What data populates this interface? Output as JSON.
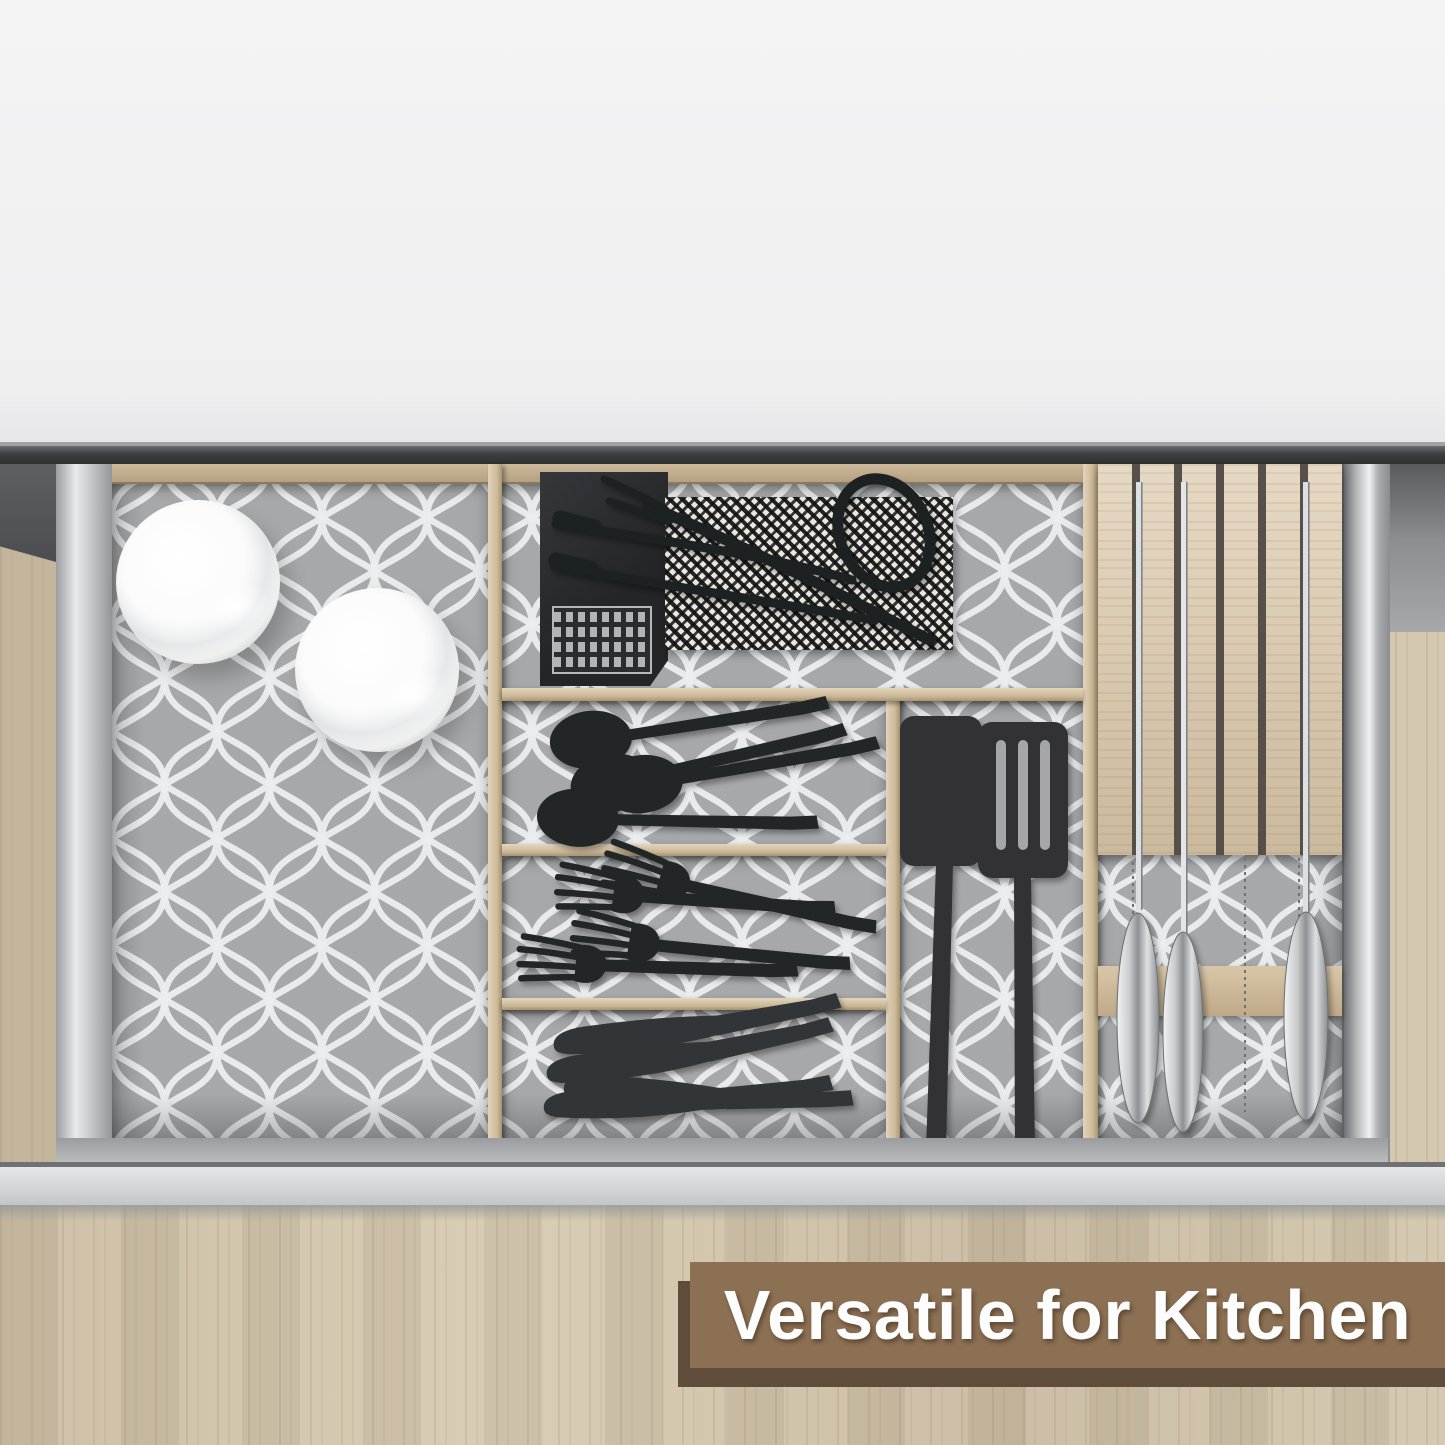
{
  "banner": {
    "label": "Versatile for Kitchen",
    "background": "#8c7054",
    "shadow": "#5f4c3a",
    "text_color": "#fdfdfd"
  },
  "scene": {
    "type": "product-photo",
    "subject": "Open kitchen drawer, top view, organized with gray quatrefoil shelf liner, wooden dividers, cutlery and a knife block",
    "items": [
      {
        "name": "white-bowl",
        "count": 2
      },
      {
        "name": "black-spoon",
        "count": 4
      },
      {
        "name": "black-fork",
        "count": 4
      },
      {
        "name": "black-table-knife",
        "count": 4
      },
      {
        "name": "black-spatula-turner",
        "count": 2
      },
      {
        "name": "black-grill-tongs",
        "count": 1
      },
      {
        "name": "black-grill-fork",
        "count": 1
      },
      {
        "name": "woven-houndstooth-mat",
        "count": 1
      },
      {
        "name": "black-notebook-with-building-print",
        "count": 1
      },
      {
        "name": "knife-blade-in-block",
        "count": 3
      },
      {
        "name": "steel-knife-handle",
        "count": 3
      }
    ],
    "colors": {
      "wall": "#f2f2f3",
      "countertop_edge": "#3c3e41",
      "cabinet_wood": "#cfc1a8",
      "liner_base": "#a6a8aa",
      "liner_pattern": "#ecedee",
      "divider_wood": "#d5c3a6",
      "drawer_metal": "#d5d6d8",
      "utensil_black": "#242628",
      "knife_gray": "#333537",
      "steel": "#c3c5c7"
    }
  }
}
